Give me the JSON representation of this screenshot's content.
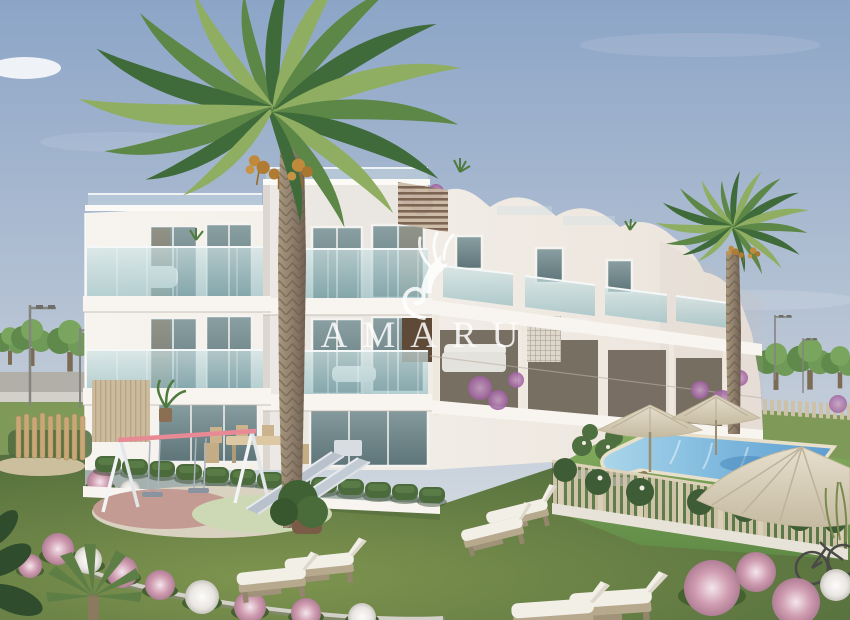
{
  "scene": {
    "description": "3D exterior rendering of a modern white three-storey apartment residence with glass balconies, arched rooftops, two date palm trees, landscaped garden with flower beds, children's playground, sun loungers and a fenced swimming pool with parasols"
  },
  "watermark": {
    "text": "AMARU",
    "logo": "winged-griffin"
  },
  "palette": {
    "sky_top": "#8ca5c7",
    "sky_horizon": "#dfe3e6",
    "building_light": "#f7f4ef",
    "building_shade": "#e4ddd4",
    "fascia": "#f8f5f0",
    "glass_light": "#cfe3e4",
    "glass_dark": "#93bcc2",
    "window_glass": "#5d7478",
    "lawn_light": "#7e944f",
    "lawn_dark": "#4d683a",
    "pool_light": "#aad6ea",
    "pool_deep": "#5e9ed0",
    "deck_turf": "#79a257",
    "umbrella": "#d8cfba",
    "fence_slat": "#cdc2a8",
    "flower_pink": "#cf9cb0",
    "bougainvillea": "#9d5f9e",
    "palm_dark": "#3f6b3a",
    "palm_mid": "#5d8746",
    "palm_light": "#8fae62",
    "palm_trunk": "#9b8a77",
    "mat_pink": "#c49b93",
    "mat_green": "#cdd9b4",
    "wood_fence": "#c9a878",
    "road": "#b2afa9",
    "stone_curb": "#d3d0c9"
  }
}
